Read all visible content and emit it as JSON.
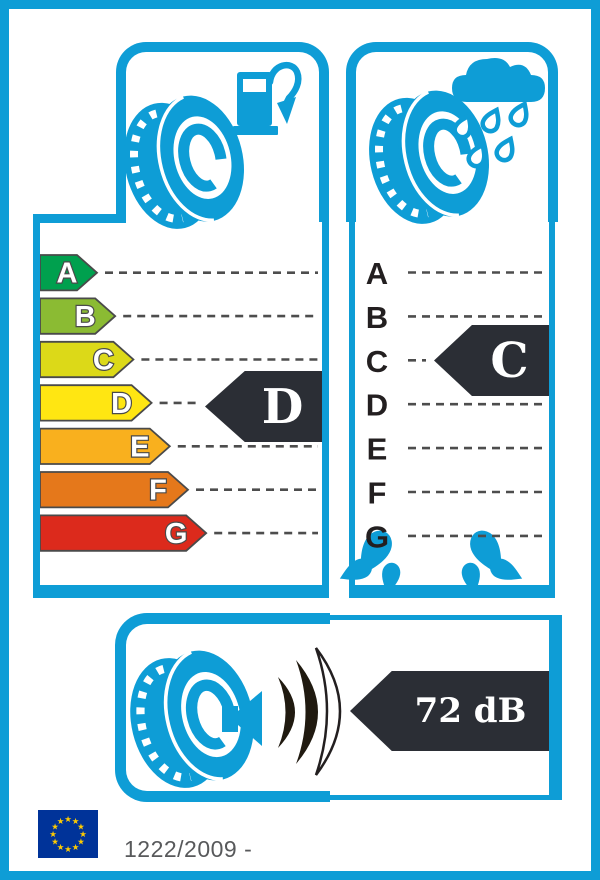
{
  "label_title": "EU Tyre Label",
  "colors": {
    "frame_blue": "#0e9dd6",
    "arrow_dark": "#2b2e35",
    "dash_grey": "#4d4d4d",
    "letter_outline": "#4a4a4a",
    "footer_text_grey": "#58595b",
    "eu_flag_blue": "#003399",
    "star_yellow": "#ffcc00",
    "wave_dark": "#201a10"
  },
  "fuel_efficiency": {
    "icon": "tyre-with-fuel-pump-icon",
    "classes": [
      {
        "letter": "A",
        "color": "#00a04e"
      },
      {
        "letter": "B",
        "color": "#8bbb33"
      },
      {
        "letter": "C",
        "color": "#dcd918"
      },
      {
        "letter": "D",
        "color": "#ffe612"
      },
      {
        "letter": "E",
        "color": "#f9b01e"
      },
      {
        "letter": "F",
        "color": "#e5781b"
      },
      {
        "letter": "G",
        "color": "#dc2a1c"
      }
    ],
    "rating": "D"
  },
  "wet_grip": {
    "icon": "tyre-with-rain-cloud-icon",
    "classes": [
      "A",
      "B",
      "C",
      "D",
      "E",
      "F",
      "G"
    ],
    "rating": "C"
  },
  "noise": {
    "icon": "tyre-with-speaker-sound-waves-icon",
    "value": "72 dB",
    "waves_filled": 2,
    "waves_total": 3
  },
  "footer": {
    "regulation_text": "1222/2009 -",
    "eu_flag_stars": 12
  }
}
